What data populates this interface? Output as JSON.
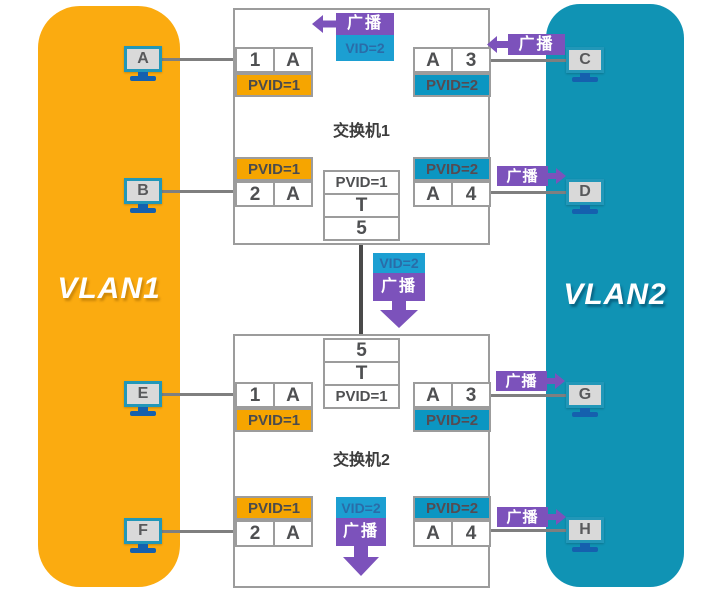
{
  "diagram_title": "VLAN broadcast domain diagram",
  "colors": {
    "vlan1_fill": "#FBAB10",
    "vlan2_fill": "#1093B4",
    "pvid1_fill": "#F6A500",
    "pvid2_fill": "#0B96C2",
    "broadcast_purple": "#7C52BB",
    "vid_tag_blue": "#1C9FD2",
    "border_gray": "#9C9C9C",
    "line_gray": "#7F7F7F"
  },
  "vlan1": {
    "label": "VLAN1"
  },
  "vlan2": {
    "label": "VLAN2"
  },
  "switch1": {
    "title": "交换机1",
    "port1": {
      "cells": [
        "1",
        "A"
      ],
      "pvid": "PVID=1"
    },
    "port3": {
      "cells": [
        "A",
        "3"
      ],
      "pvid": "PVID=2"
    },
    "port2": {
      "cells": [
        "2",
        "A"
      ],
      "pvid": "PVID=1"
    },
    "port4": {
      "cells": [
        "A",
        "4"
      ],
      "pvid": "PVID=2"
    },
    "trunk": {
      "rows": [
        "PVID=1",
        "T",
        "5"
      ]
    }
  },
  "switch2": {
    "title": "交换机2",
    "trunk": {
      "rows": [
        "5",
        "T",
        "PVID=1"
      ]
    },
    "port1": {
      "cells": [
        "1",
        "A"
      ],
      "pvid": "PVID=1"
    },
    "port3": {
      "cells": [
        "A",
        "3"
      ],
      "pvid": "PVID=2"
    },
    "port2": {
      "cells": [
        "2",
        "A"
      ],
      "pvid": "PVID=1"
    },
    "port4": {
      "cells": [
        "A",
        "4"
      ],
      "pvid": "PVID=2"
    }
  },
  "hosts": {
    "a": "A",
    "b": "B",
    "c": "C",
    "d": "D",
    "e": "E",
    "f": "F",
    "g": "G",
    "h": "H"
  },
  "broadcast": {
    "label": "广播",
    "vid": "VID=2"
  }
}
